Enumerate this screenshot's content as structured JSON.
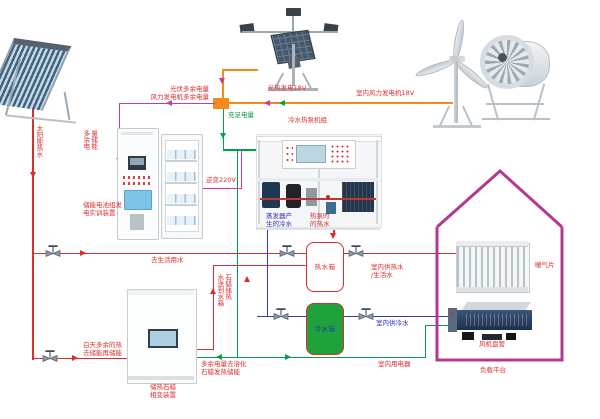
{
  "colors": {
    "hot_water_line": "#dd2c2c",
    "chilled_water_line": "#3a3ab8",
    "sufficient_power_line": "#00a14b",
    "surplus_power_line": "#cb3aa2",
    "power_bus_line": "#f28a1e",
    "house_outline": "#b5388f",
    "cold_tank_fill": "#1ea33c"
  },
  "solar": {
    "vertical": "太阳能热水",
    "to_domestic": "去生活用水",
    "day_surplus_l1": "白天多余的热",
    "day_surplus_l2": "去储能再储能"
  },
  "pv": {
    "label": "光热发电18V"
  },
  "wind": {
    "label": "室内风力发电机18V"
  },
  "bus": {
    "pv_surplus": "光伏多余电量",
    "wind_surplus": "风力发电机多余电量",
    "sufficient": "充足电量",
    "inverter": "逆变220V"
  },
  "battery": {
    "store_col_left": "多余电",
    "store_col_right": "量储能",
    "name_l1": "储能电池组发",
    "name_l2": "电实训装置"
  },
  "heatpump": {
    "title": "冷水热泵机组",
    "evap_l1": "蒸发器产",
    "evap_l2": "生的冷水",
    "hot_l1": "热泵时",
    "hot_l2": "的热水"
  },
  "tank": {
    "hot": "热水箱",
    "cold": "冷水箱"
  },
  "paraffin": {
    "name_l1": "储热石蜡",
    "name_l2": "相变装置",
    "riser_col_left": "水送到水箱",
    "riser_col_right": "石蜡储热",
    "melt_l1": "多余电量去溶化",
    "melt_l2": "石蜡发热储能"
  },
  "house": {
    "hot_l1": "室内供热水",
    "hot_l2": "/生活水",
    "cold": "室内供冷水",
    "appliance": "室内用电器",
    "radiator": "暖气片",
    "fancoil": "风机盘管",
    "platform": "负载平台"
  }
}
